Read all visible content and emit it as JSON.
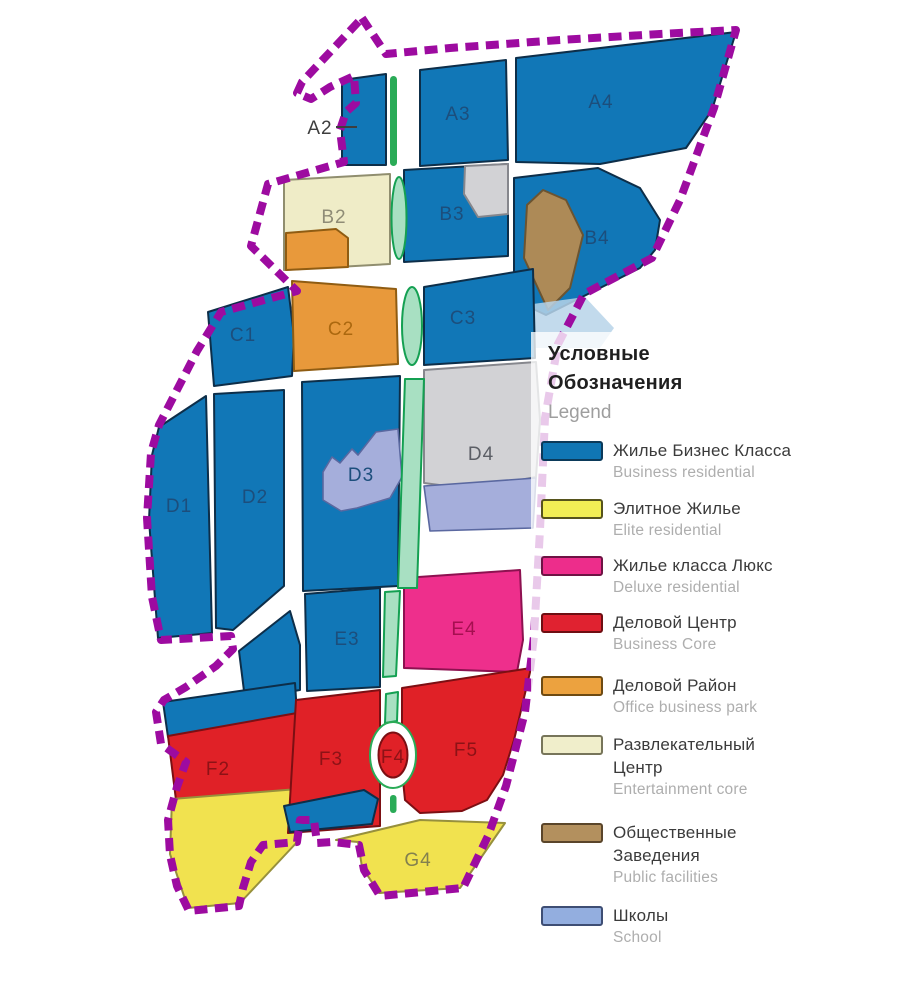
{
  "palette": {
    "business_residential_blue": "#1177b7",
    "elite_yellow": "#f1e24f",
    "deluxe_pink": "#ee2f8c",
    "business_core_red": "#e02127",
    "office_park_orange": "#e8993b",
    "entertainment_cream": "#efecc7",
    "public_brown": "#ad8a57",
    "school_lavender": "#a5aedb",
    "reserve_gray": "#d2d2d5",
    "park_green_fill": "#a8e0c2",
    "park_green_dark": "#2aab57",
    "boundary_purple": "#9d0ba0",
    "water_wash": "#b7d4e9"
  },
  "map": {
    "zones": [
      {
        "id": "A2",
        "label": "A2"
      },
      {
        "id": "A3",
        "label": "A3"
      },
      {
        "id": "A4",
        "label": "A4"
      },
      {
        "id": "B2",
        "label": "B2"
      },
      {
        "id": "B3",
        "label": "B3"
      },
      {
        "id": "B4",
        "label": "B4"
      },
      {
        "id": "C1",
        "label": "C1"
      },
      {
        "id": "C2",
        "label": "C2"
      },
      {
        "id": "C3",
        "label": "C3"
      },
      {
        "id": "D1",
        "label": "D1"
      },
      {
        "id": "D2",
        "label": "D2"
      },
      {
        "id": "D3",
        "label": "D3"
      },
      {
        "id": "D4",
        "label": "D4"
      },
      {
        "id": "E3",
        "label": "E3"
      },
      {
        "id": "E4",
        "label": "E4"
      },
      {
        "id": "F2",
        "label": "F2"
      },
      {
        "id": "F3",
        "label": "F3"
      },
      {
        "id": "F4",
        "label": "F4"
      },
      {
        "id": "F5",
        "label": "F5"
      },
      {
        "id": "G4",
        "label": "G4"
      }
    ]
  },
  "legend": {
    "title_ru_line1": "Условные",
    "title_ru_line2": "Обозначения",
    "title_en": "Legend",
    "items": [
      {
        "ru1": "Жилье Бизнес Класса",
        "ru2": "",
        "en": "Business residential",
        "color": "#1076b4",
        "border": "#0b3a5a"
      },
      {
        "ru1": "Элитное Жилье",
        "ru2": "",
        "en": "Elite residential",
        "color": "#f2ee55",
        "border": "#56531c"
      },
      {
        "ru1": "Жилье класса Люкс",
        "ru2": "",
        "en": "Deluxe residential",
        "color": "#ed2d8b",
        "border": "#6e1344"
      },
      {
        "ru1": "Деловой Центр",
        "ru2": "",
        "en": "Business Core",
        "color": "#e02230",
        "border": "#6e0e12"
      },
      {
        "ru1": "Деловой Район",
        "ru2": "",
        "en": "Office business park",
        "color": "#eca23f",
        "border": "#6e4a12"
      },
      {
        "ru1": "Развлекательный",
        "ru2": "Центр",
        "en": "Entertainment core",
        "color": "#f0eecb",
        "border": "#77755a"
      },
      {
        "ru1": "Общественные",
        "ru2": "Заведения",
        "en": "Public facilities",
        "color": "#b3905e",
        "border": "#5a452a"
      },
      {
        "ru1": "Школы",
        "ru2": "",
        "en": "School",
        "color": "#93aedf",
        "border": "#3e4e74"
      }
    ]
  }
}
